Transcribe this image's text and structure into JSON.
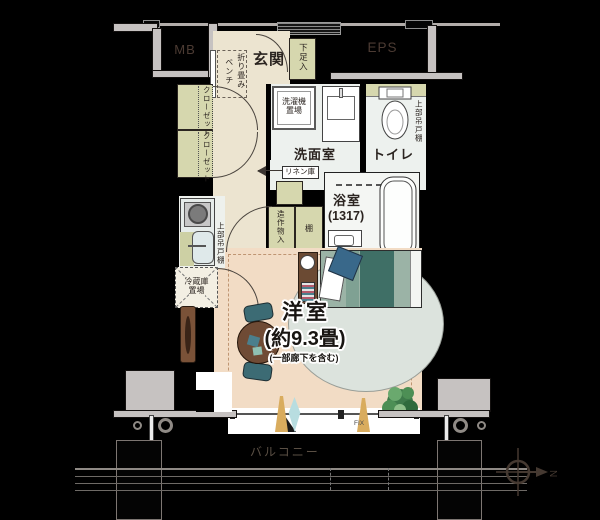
{
  "plan": {
    "corridor": {
      "mb": "MB",
      "eps": "EPS"
    },
    "entrance": {
      "name": "玄関",
      "shoe_box": "下足入",
      "bench_line1": "折り畳み",
      "bench_line2": "ベンチ"
    },
    "storage": {
      "closet_upper": "クローゼット",
      "closet_lower": "クローゼット",
      "linen": "リネン庫",
      "builtin": "造作物入",
      "shelf": "棚"
    },
    "washroom": {
      "name": "洗面室",
      "washer_line1": "洗濯機",
      "washer_line2": "置場"
    },
    "toilet": {
      "name": "トイレ",
      "upper_cabinet": "上部吊戸棚"
    },
    "bathroom": {
      "name": "浴室",
      "size": "(1317)"
    },
    "kitchen": {
      "upper_cabinet": "上部吊戸棚",
      "fridge_line1": "冷蔵庫",
      "fridge_line2": "置場"
    },
    "main_room": {
      "name": "洋室",
      "size": "(約9.3畳)",
      "note": "(一部廊下を含む)"
    },
    "balcony": {
      "name": "バルコニー",
      "fix": "FIX"
    },
    "compass": {
      "north": "N"
    },
    "colors": {
      "background": "#000000",
      "concrete_gray": "#c6c2c1",
      "hall_beige": "#ece4d0",
      "room_peach": "#f2dcc5",
      "closet_olive": "#d6d7ae",
      "wet_area": "#edf1ee",
      "bed_dark_teal": "#3f6f66",
      "bed_light_sage": "#9bb3a6",
      "table_brown": "#6f4b35",
      "chair_teal": "#3c6b74",
      "rug_gray": "#dce3dd",
      "curtain_tan": "#d9ac5e",
      "curtain_blue": "#b8dde0",
      "plant_green": "#3e7a4a"
    }
  }
}
